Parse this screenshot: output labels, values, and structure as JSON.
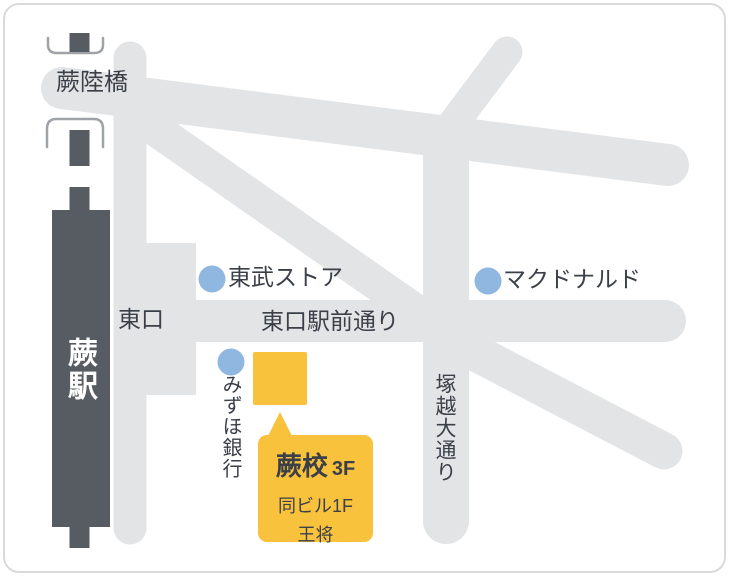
{
  "colors": {
    "road_gray": "#e3e4e5",
    "rail_station_dark": "#575b62",
    "marker_blue": "#8fb7df",
    "accent_yellow": "#f9c23d",
    "text_dark": "#3a3f48",
    "station_text": "#ffffff",
    "frame_border": "#d9dadc",
    "bridge_bracket_gray": "#9fa3a8"
  },
  "labels": {
    "bridge": "蕨陸橋",
    "station": "蕨駅",
    "east_exit": "東口",
    "ekimae_street": "東口駅前通り",
    "tsukagoshi_street": "塚越大通り"
  },
  "landmarks": [
    {
      "name": "東武ストア"
    },
    {
      "name": "マクドナルド"
    },
    {
      "name": "みずほ銀行"
    }
  ],
  "callout": {
    "school_name": "蕨校",
    "floor": "3F",
    "note_line1": "同ビル1F",
    "note_line2": "王将"
  }
}
